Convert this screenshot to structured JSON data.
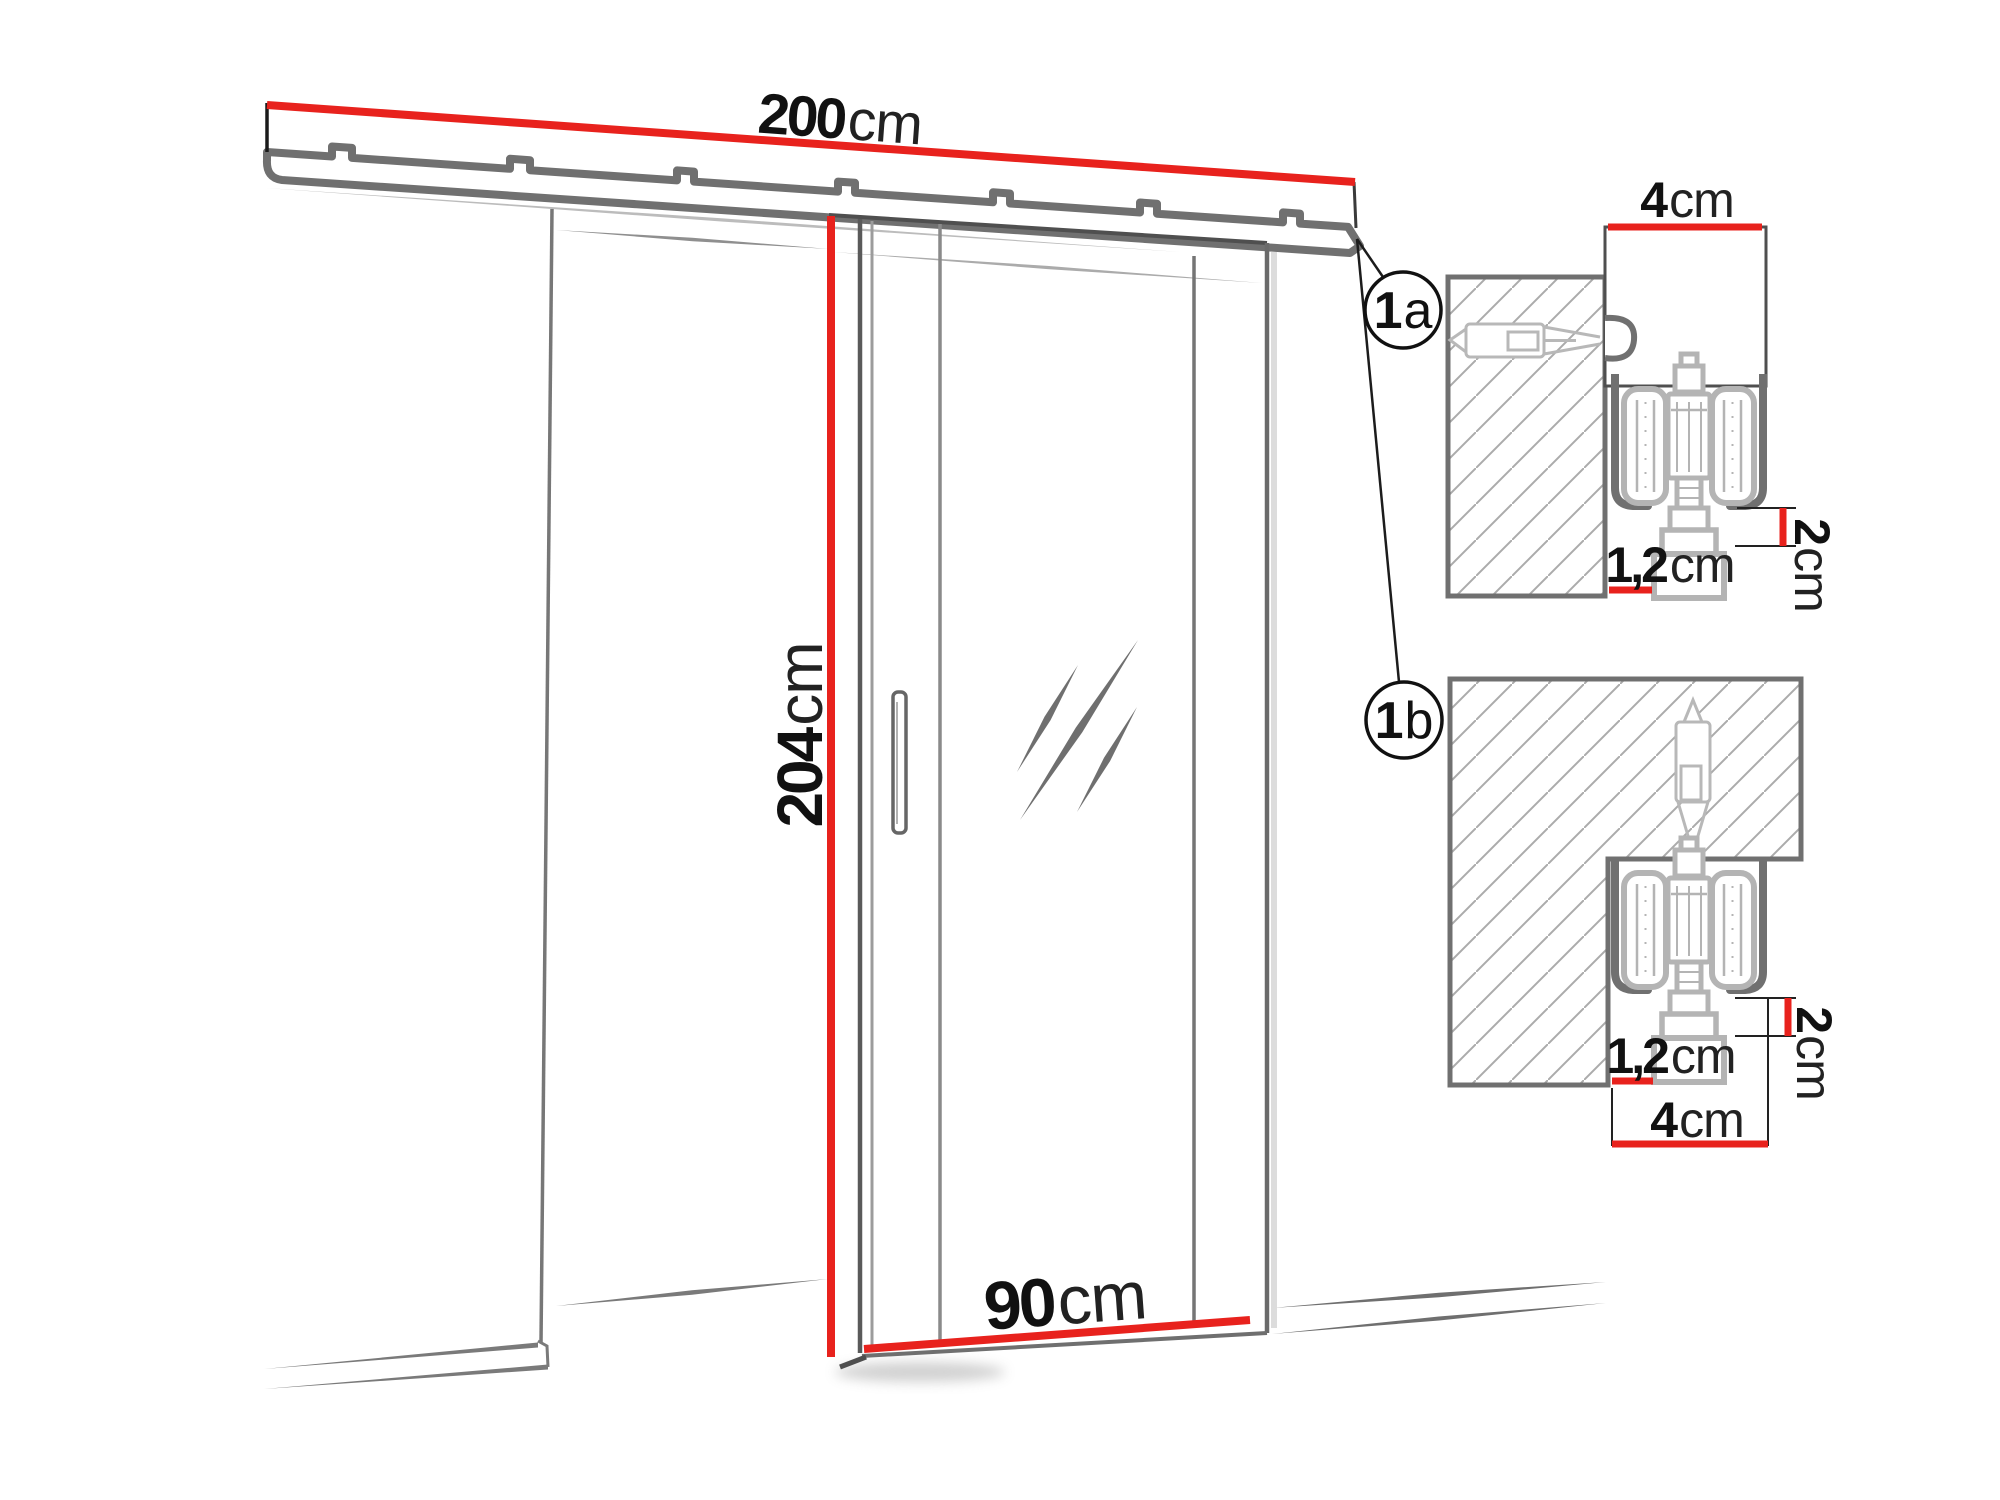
{
  "diagram": {
    "main": {
      "track_width": {
        "value": "200",
        "unit": "cm"
      },
      "door_height": {
        "value": "204",
        "unit": "cm"
      },
      "door_width": {
        "value": "90",
        "unit": "cm"
      }
    },
    "callout_a": {
      "number": "1",
      "letter": "a"
    },
    "callout_b": {
      "number": "1",
      "letter": "b"
    },
    "detail_a": {
      "profile_width": {
        "value": "4",
        "unit": "cm"
      },
      "clearance": {
        "value": "2",
        "unit": "cm"
      },
      "gap": {
        "value": "1,2",
        "unit": "cm"
      }
    },
    "detail_b": {
      "profile_width": {
        "value": "4",
        "unit": "cm"
      },
      "clearance": {
        "value": "2",
        "unit": "cm"
      },
      "gap": {
        "value": "1,2",
        "unit": "cm"
      }
    },
    "colors": {
      "accent_red": "#e8221d",
      "outline_gray": "#707070",
      "trolley_gray": "#b4b4b4",
      "text_black": "#141414"
    }
  }
}
